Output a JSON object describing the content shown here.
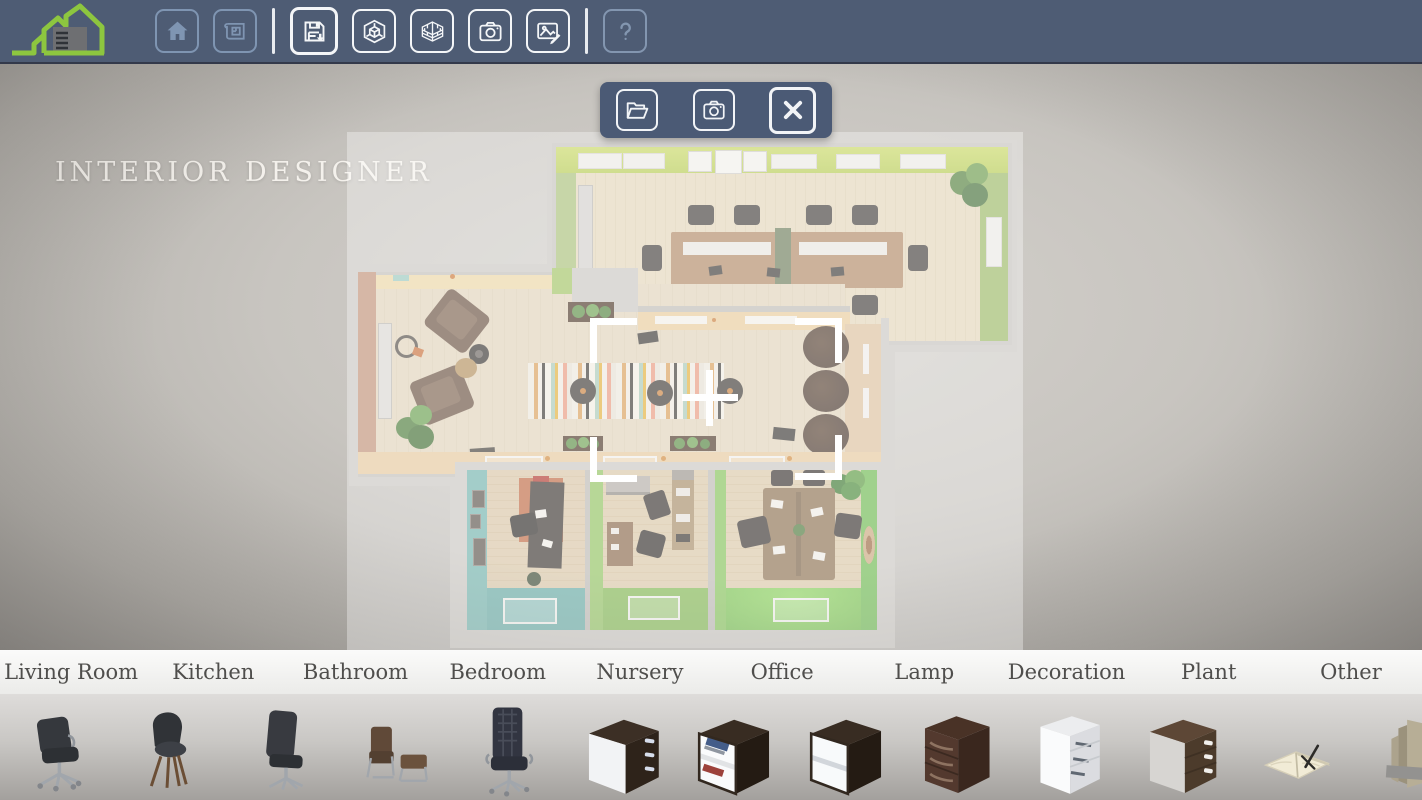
{
  "app": {
    "title": "INTERIOR DESIGNER",
    "logo": "green-house-logo"
  },
  "colors": {
    "toolbar_bg": "#4e5c74",
    "toolbar_icon_inactive": "#7f95b2",
    "toolbar_icon_active": "#f4f6f8",
    "logo_green": "#8dc63f",
    "dialog_bg": "#4b5a75",
    "canvas_gray": "#c8c5c0",
    "room_green_wall": "#b8d435",
    "room_teal_wall": "#5aa9a5",
    "room_orange_wall": "#b5795a",
    "selection_white": "#ffffff",
    "category_text": "#4f4e4c"
  },
  "toolbar": {
    "groups": [
      [
        {
          "icon": "home-icon",
          "name": "home",
          "state": "inactive"
        },
        {
          "icon": "blueprint-icon",
          "name": "floorplan",
          "state": "inactive"
        }
      ],
      [
        {
          "icon": "save-icon",
          "name": "save",
          "state": "active",
          "primary": true
        },
        {
          "icon": "cube-3d-icon",
          "name": "view-3d",
          "state": "active"
        },
        {
          "icon": "brick-wall-icon",
          "name": "walls-3d",
          "state": "active"
        },
        {
          "icon": "camera-icon",
          "name": "camera",
          "state": "active"
        },
        {
          "icon": "image-edit-icon",
          "name": "screenshot-edit",
          "state": "active"
        }
      ],
      [
        {
          "icon": "help-icon",
          "name": "help",
          "state": "disabled"
        }
      ]
    ]
  },
  "dialog": {
    "buttons": [
      {
        "icon": "folder-open-icon",
        "name": "open-project"
      },
      {
        "icon": "camera-icon",
        "name": "take-photo"
      },
      {
        "icon": "close-x-icon",
        "name": "close-dialog",
        "big": true
      }
    ]
  },
  "categories": [
    "Living Room",
    "Kitchen",
    "Bathroom",
    "Bedroom",
    "Nursery",
    "Office",
    "Lamp",
    "Decoration",
    "Plant",
    "Other"
  ],
  "furniture_items": [
    {
      "type": "office-chair"
    },
    {
      "type": "side-chair"
    },
    {
      "type": "swivel-chair"
    },
    {
      "type": "lounge-chair-ottoman"
    },
    {
      "type": "executive-chair"
    },
    {
      "type": "drawer-box-white-front"
    },
    {
      "type": "cube-shelf-books"
    },
    {
      "type": "cube-shelf-empty"
    },
    {
      "type": "pedestal-dark"
    },
    {
      "type": "pedestal-white"
    },
    {
      "type": "pedestal-brown"
    },
    {
      "type": "open-notebook"
    },
    {
      "type": "file-folders"
    }
  ],
  "selection": {
    "crosshair": true,
    "brackets": 4
  }
}
